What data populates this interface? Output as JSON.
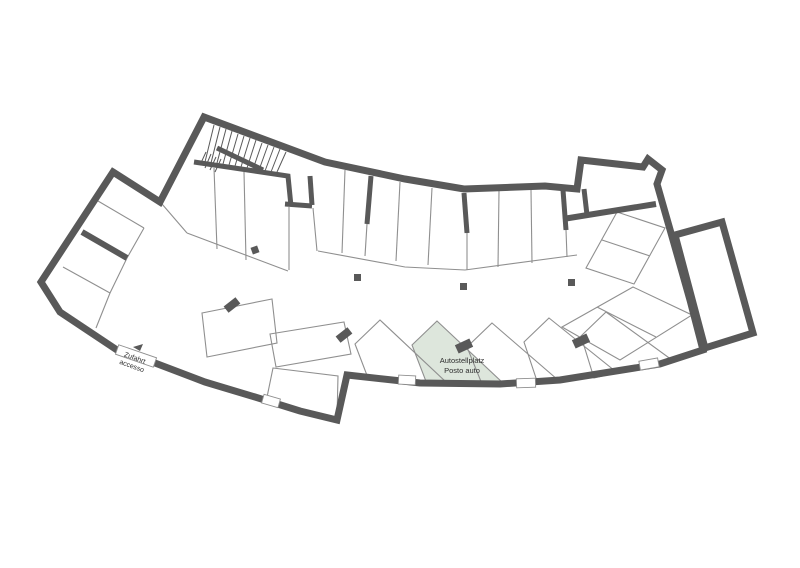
{
  "plan": {
    "labels": {
      "highlight_line1": "Autostellplatz",
      "highlight_line2": "Posto auto",
      "access_line1": "Zufahrt",
      "access_line2": "accesso"
    },
    "colors": {
      "wall": "#595959",
      "thin": "#8f8f8f",
      "highlight": "#dde6dc",
      "text": "#2e2e2e",
      "background": "#ffffff"
    }
  }
}
